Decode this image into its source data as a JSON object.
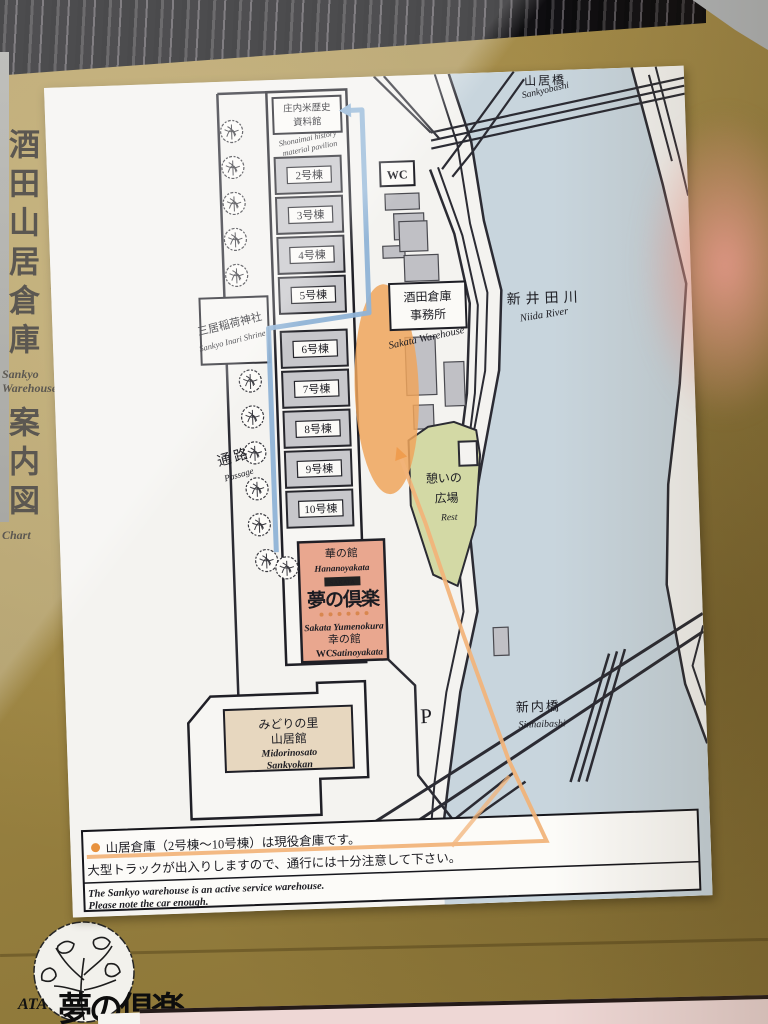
{
  "side_title": {
    "jp": "酒田山居倉庫",
    "furigana": "さんきょ",
    "en_line1": "Sankyo",
    "en_line2": "Warehouse",
    "jp_sub": "案内図",
    "en_sub": "Chart"
  },
  "map": {
    "sankyobashi_jp": "山居橋",
    "sankyobashi_en": "Sankyobashi",
    "niida_jp": "新井田川",
    "niida_en": "Niida River",
    "sinnaibashi_jp": "新内橋",
    "sinnaibashi_en": "Sinnaibashi",
    "history_jp1": "庄内米歴史",
    "history_jp2": "資料館",
    "history_en1": "Shonaimai history",
    "history_en2": "material pavilion",
    "wc": "WC",
    "office_jp1": "酒田倉庫",
    "office_jp2": "事務所",
    "office_en": "Sakata Warehouse",
    "shrine_jp": "三居稲荷神社",
    "shrine_en": "Sankyo Inari Shrine",
    "passage_jp": "通路",
    "passage_en": "Passage",
    "rest_jp1": "憩いの",
    "rest_jp2": "広場",
    "rest_en": "Rest",
    "warehouses": [
      "2号棟",
      "3号棟",
      "4号棟",
      "5号棟",
      "6号棟",
      "7号棟",
      "8号棟",
      "9号棟",
      "10号棟"
    ],
    "hana_jp": "華の館",
    "hana_en": "Hananoyakata",
    "logo_top": "SAKATA",
    "logo_main": "夢の倶楽",
    "yume_en": "Sakata Yumenokura",
    "sati_jp": "幸の館",
    "sati_wc": "WC",
    "sati_en": "Satinoyakata",
    "midori_jp1": "みどりの里",
    "midori_jp2": "山居館",
    "midori_en1": "Midorinosato",
    "midori_en2": "Sankyokan",
    "parking": "P",
    "note_jp1": "山居倉庫（2号棟～10号棟）は現役倉庫です。",
    "note_jp2": "大型トラックが出入りしますので、通行には十分注意して下さい。",
    "note_en1": "The Sankyo warehouse is an active service warehouse.",
    "note_en2": "Please note the car enough."
  },
  "stamp": {
    "partial_text": "ATA",
    "brush_text": "夢の倶楽"
  },
  "colors": {
    "board_gold": "#9a8342",
    "panel_white": "#f4f3f0",
    "river_blue": "#c8d5dd",
    "route_blue": "#8fb3d6",
    "route_orange": "#f0a55c",
    "rest_green": "#d3d9a5",
    "building_gray": "#c7c7cb",
    "yume_pink": "#e9a78f",
    "midori_tan": "#e7d7bf"
  }
}
